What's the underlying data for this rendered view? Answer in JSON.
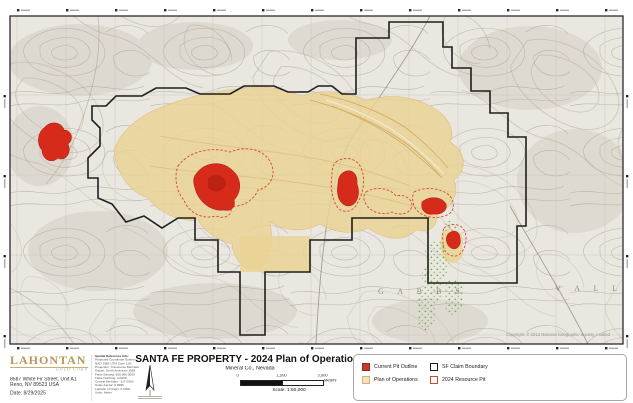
{
  "map": {
    "credit": "Copyright: © 2013 National Geographic Society, i-cubed",
    "labels": {
      "range": "G A B B S",
      "valley": "V A L L E Y"
    }
  },
  "title_block": {
    "title": "SANTA FE PROPERTY - 2024 Plan of Operations",
    "subtitle": "Mineral Co., Nevada",
    "scale_text": "Scale: 1:50,000",
    "scalebar": {
      "zero": "0",
      "mid": "1,500",
      "end": "3,000",
      "units": "Meters"
    }
  },
  "logo": {
    "name": "LAHONTAN",
    "tagline": "GOLD CORP",
    "address_line1": "8587 White Fir Street, Unit A1",
    "address_line2": "Reno, NV 89523 USA",
    "date": "Date: 8/29/2025"
  },
  "spatial_reference": {
    "heading": "Spatial Reference Info:",
    "lines": [
      "Projected Coordinate System:",
      "NAD 1983 UTM Zone 11N",
      "Projection: Transverse Mercator",
      "Datum: North American 1983",
      "False Easting: 500,000.0000",
      "False Northing: 0.0000",
      "Central Meridian: -117.0000",
      "Scale Factor: 0.9996",
      "Latitude of Origin: 0.0000",
      "Units: Meter"
    ]
  },
  "legend": {
    "items": [
      {
        "label": "Current Pit Outline"
      },
      {
        "label": "Plan of Operations"
      },
      {
        "label": "SF Claim Boundary"
      },
      {
        "label": "2024 Resource Pit"
      }
    ]
  },
  "colors": {
    "current_pit_fill": "#d62b1a",
    "plan_of_operations_fill": "#ead294",
    "claim_boundary": "#141414",
    "resource_pit_outline": "#d0402a",
    "vegetation_green": "#6fae4a",
    "logo_gold": "#b5975a",
    "topo_background": "#eae7e1"
  }
}
